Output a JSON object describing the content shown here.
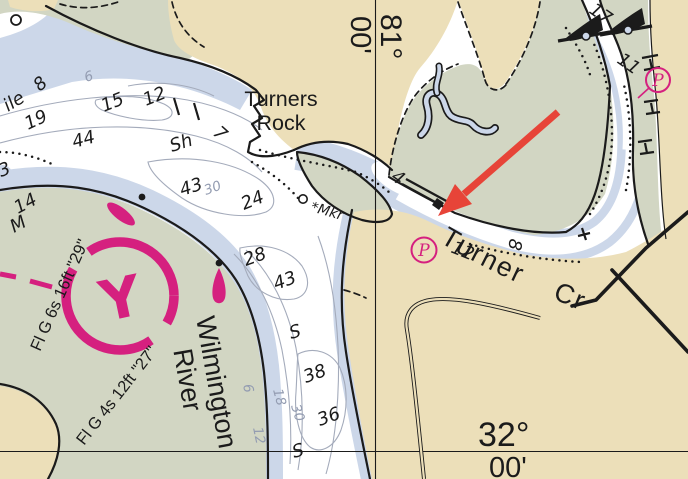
{
  "colors": {
    "water": "#ccd7e9",
    "marsh": "#d2d6c3",
    "land": "#ecdfb9",
    "deep": "#ffffff",
    "ink": "#1b1b1b",
    "contour_label": "#939cb1",
    "magenta": "#d5207f",
    "arrow_red": "#e74438"
  },
  "labels": {
    "turners_rock_1": "Turners",
    "turners_rock_2": "Rock",
    "turner_creek": "Turner Cr",
    "river_1": "Wilmington",
    "river_2": "River",
    "marker": "Mkr",
    "marker_star": "*",
    "shore_partial": "ile"
  },
  "graticule": {
    "lon_deg": "81°",
    "lon_min": "00'",
    "lat_deg": "32°",
    "lat_min": "00'"
  },
  "lights": [
    {
      "label": "Fl G 6s 16ft \"29\""
    },
    {
      "label": "Fl G 4s 12ft \"27\""
    }
  ],
  "anchorage": {
    "letter": "Y"
  },
  "facility": {
    "p": "P"
  },
  "soundings": [
    {
      "t": "8",
      "x": 40,
      "y": 92,
      "r": -42
    },
    {
      "t": "15",
      "x": 104,
      "y": 112,
      "r": -22
    },
    {
      "t": "12",
      "x": 146,
      "y": 106,
      "r": -22
    },
    {
      "t": "19",
      "x": 28,
      "y": 130,
      "r": -25
    },
    {
      "t": "44",
      "x": 74,
      "y": 148,
      "r": -15
    },
    {
      "t": "Sh",
      "x": 172,
      "y": 152,
      "r": -18
    },
    {
      "t": "43",
      "x": 182,
      "y": 196,
      "r": -18
    },
    {
      "t": "24",
      "x": 244,
      "y": 210,
      "r": -22
    },
    {
      "t": "7",
      "x": 212,
      "y": 134,
      "r": 42,
      "fs": 20
    },
    {
      "t": "14",
      "x": 18,
      "y": 214,
      "r": -28
    },
    {
      "t": "M",
      "x": 14,
      "y": 233,
      "r": -28
    },
    {
      "t": "3",
      "x": 1,
      "y": 177,
      "r": -20
    },
    {
      "t": "28",
      "x": 246,
      "y": 266,
      "r": -20
    },
    {
      "t": "43",
      "x": 276,
      "y": 290,
      "r": -20
    },
    {
      "t": "S",
      "x": 291,
      "y": 339,
      "r": -15
    },
    {
      "t": "38",
      "x": 306,
      "y": 383,
      "r": -20
    },
    {
      "t": "36",
      "x": 320,
      "y": 426,
      "r": -20
    },
    {
      "t": "S",
      "x": 294,
      "y": 458,
      "r": -15
    },
    {
      "t": "4",
      "x": 390,
      "y": 179,
      "r": 35
    },
    {
      "t": "12",
      "x": 450,
      "y": 252,
      "r": 22
    },
    {
      "t": "8",
      "x": 510,
      "y": 238,
      "r": 100
    },
    {
      "t": "11",
      "x": 616,
      "y": 62,
      "r": 35
    },
    {
      "t": "17",
      "x": 588,
      "y": 12,
      "r": 35
    }
  ],
  "contour_labels": [
    {
      "t": "6",
      "x": 86,
      "y": 82,
      "r": -18
    },
    {
      "t": "30",
      "x": 206,
      "y": 195,
      "r": -20
    },
    {
      "t": "6",
      "x": 243,
      "y": 385,
      "r": 78
    },
    {
      "t": "18",
      "x": 273,
      "y": 390,
      "r": 75
    },
    {
      "t": "30",
      "x": 291,
      "y": 406,
      "r": 72
    },
    {
      "t": "12",
      "x": 253,
      "y": 428,
      "r": 78
    }
  ]
}
